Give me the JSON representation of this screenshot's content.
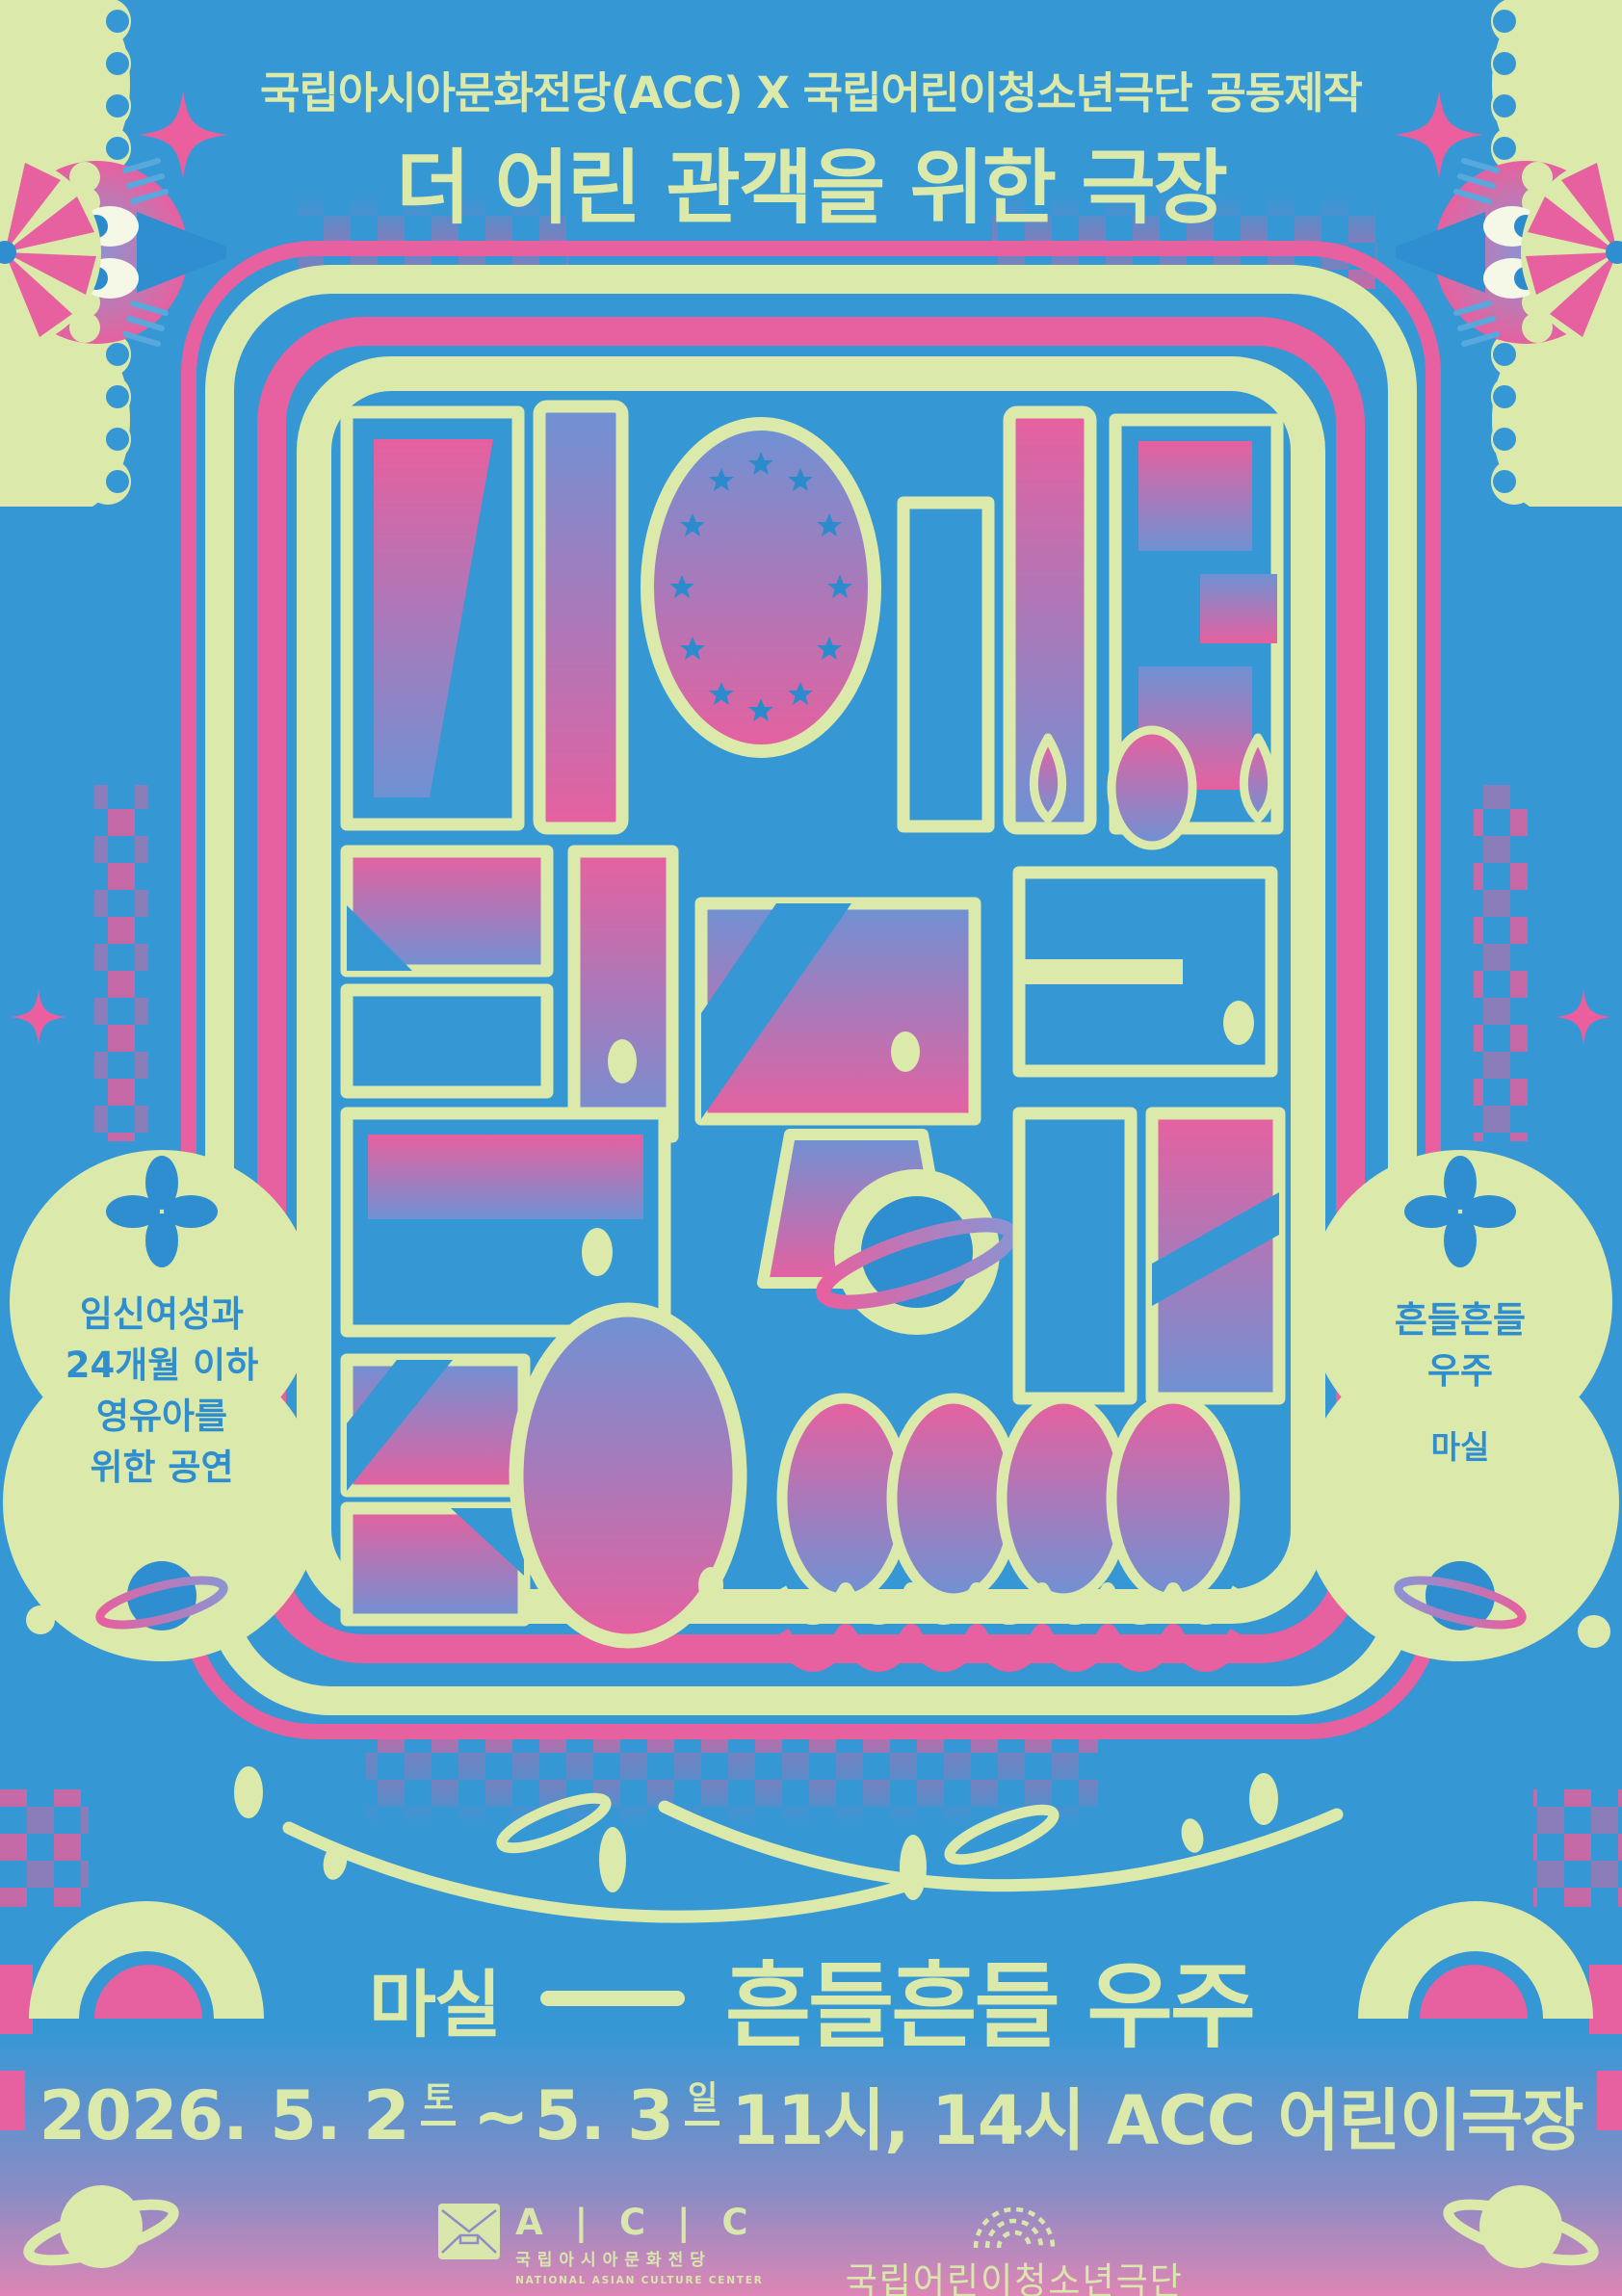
{
  "header": {
    "coproduction": "국립아시아문화전당(ACC) X 국립어린이청소년극단 공동제작",
    "program_title": "더 어린 관객을 위한 극장"
  },
  "main_title_artwork": {
    "text": "더 어린 관객을 위한 극장"
  },
  "badges": {
    "left": {
      "lines": [
        "임신여성과",
        "24개월 이하",
        "영유아를",
        "위한 공연"
      ]
    },
    "right": {
      "lines": [
        "흔들흔들",
        "우주"
      ],
      "subtitle": "마실"
    }
  },
  "show": {
    "company": "마실",
    "title": "흔들흔들 우주"
  },
  "schedule": {
    "date1": "2026. 5. 2",
    "day1": "토",
    "tilde": "~",
    "date2": "5. 3",
    "day2": "일",
    "rest": "11시, 14시 ACC 어린이극장"
  },
  "footer": {
    "acc": {
      "letters": "A | C | C",
      "korean": "국립아시아문화전당",
      "english": "NATIONAL ASIAN CULTURE CENTER"
    },
    "theater": {
      "name": "국립어린이청소년극단"
    }
  },
  "colors": {
    "background_blue": "#3697d5",
    "cream": "#dbe9ab",
    "pink": "#e7609f",
    "periwinkle": "#6e92d4",
    "icon_blue": "#2e8ecf",
    "bottom_gradient_purple": "#8a8cc5",
    "bottom_gradient_pink": "#dd86b5"
  }
}
